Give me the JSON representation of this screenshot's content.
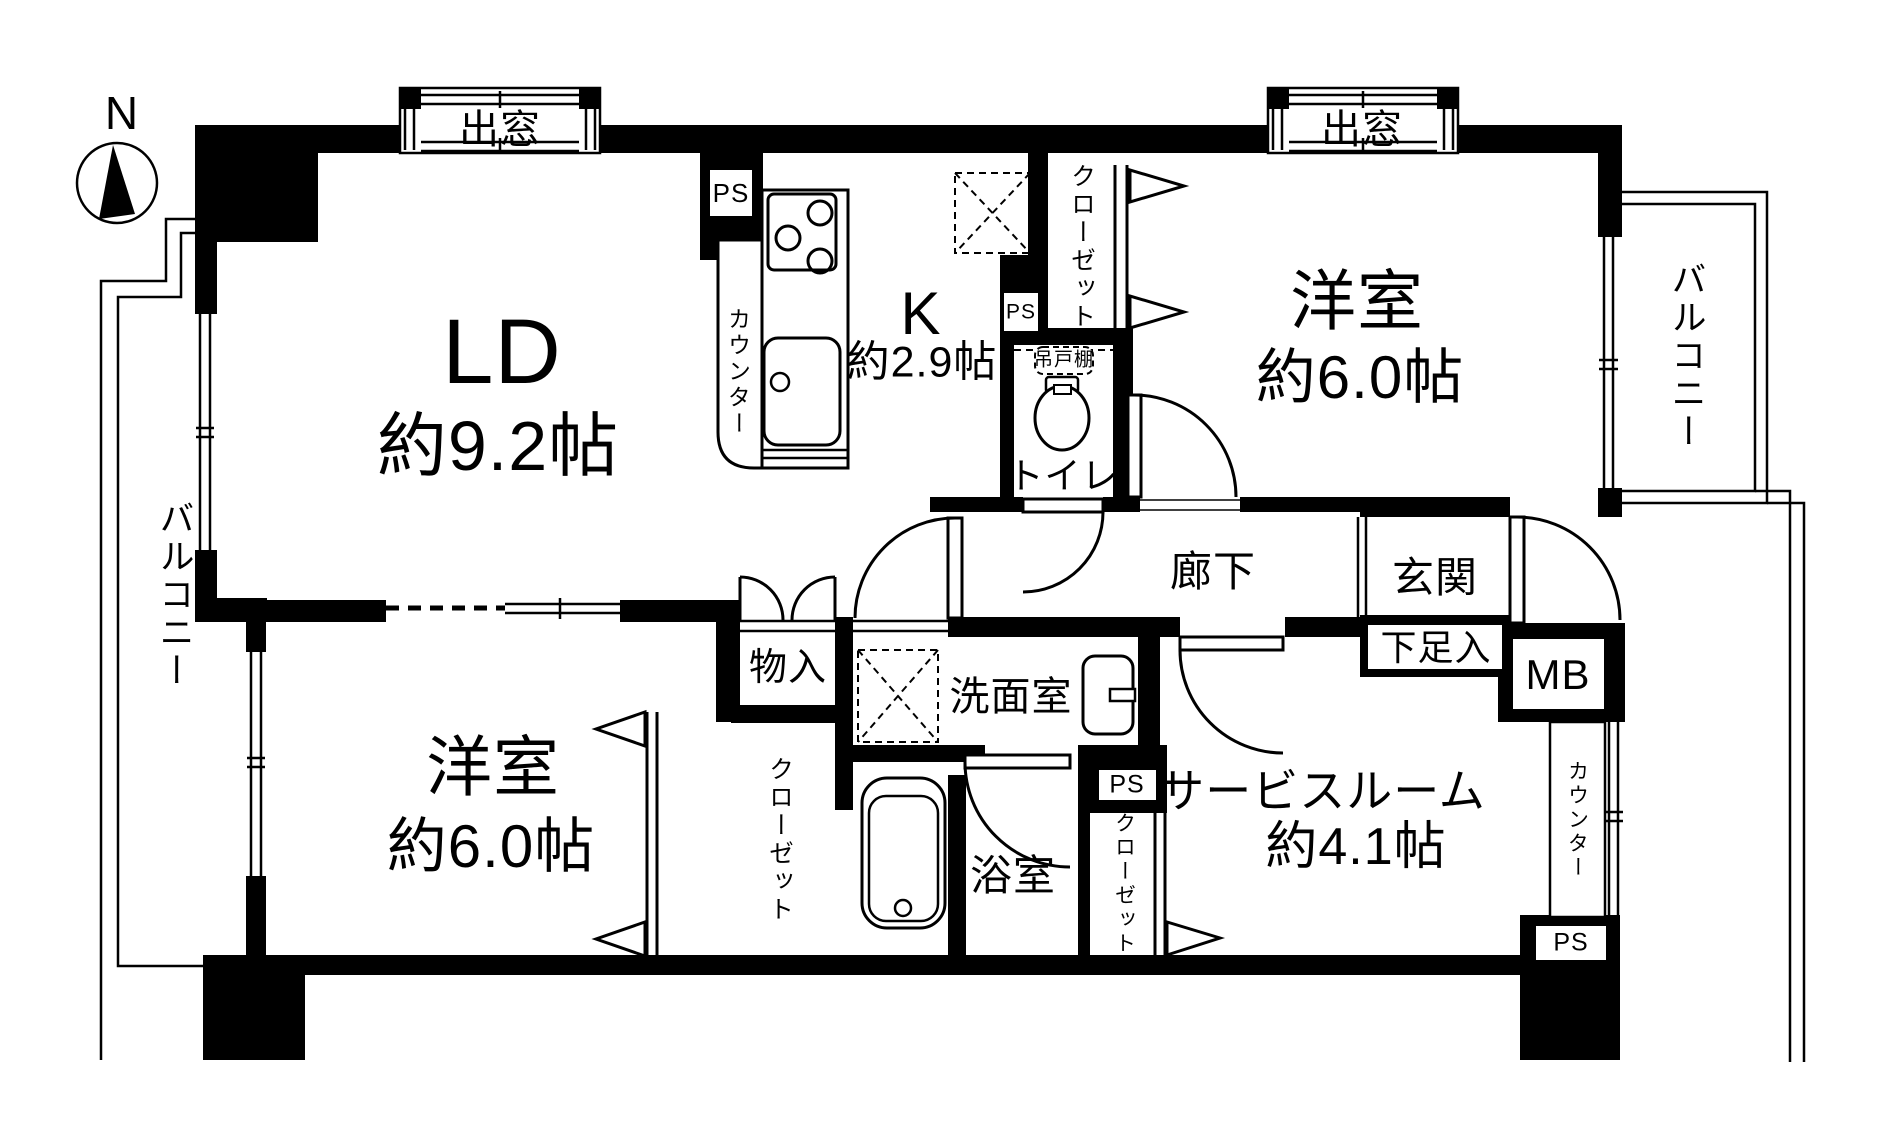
{
  "compass": {
    "north_label": "N"
  },
  "labels": {
    "bay_window": "出窓",
    "balcony": "バルコニー",
    "ld": {
      "name": "LD",
      "size": "約9.2帖"
    },
    "kitchen": {
      "name": "K",
      "size": "約2.9帖"
    },
    "western_room": {
      "name": "洋室",
      "size": "約6.0帖"
    },
    "service_room": {
      "name": "サービスルーム",
      "size": "約4.1帖"
    },
    "hallway": "廊下",
    "entrance": "玄関",
    "shoe_cabinet": "下足入",
    "meter_box": "MB",
    "pipe_space": "PS",
    "closet": "クローゼット",
    "storage": "物入",
    "washroom": "洗面室",
    "bathroom": "浴室",
    "toilet": "トイレ",
    "hanging_cupboard": "吊戸棚",
    "counter": "カウンター"
  },
  "colors": {
    "wall": "#000000",
    "background": "#ffffff"
  }
}
